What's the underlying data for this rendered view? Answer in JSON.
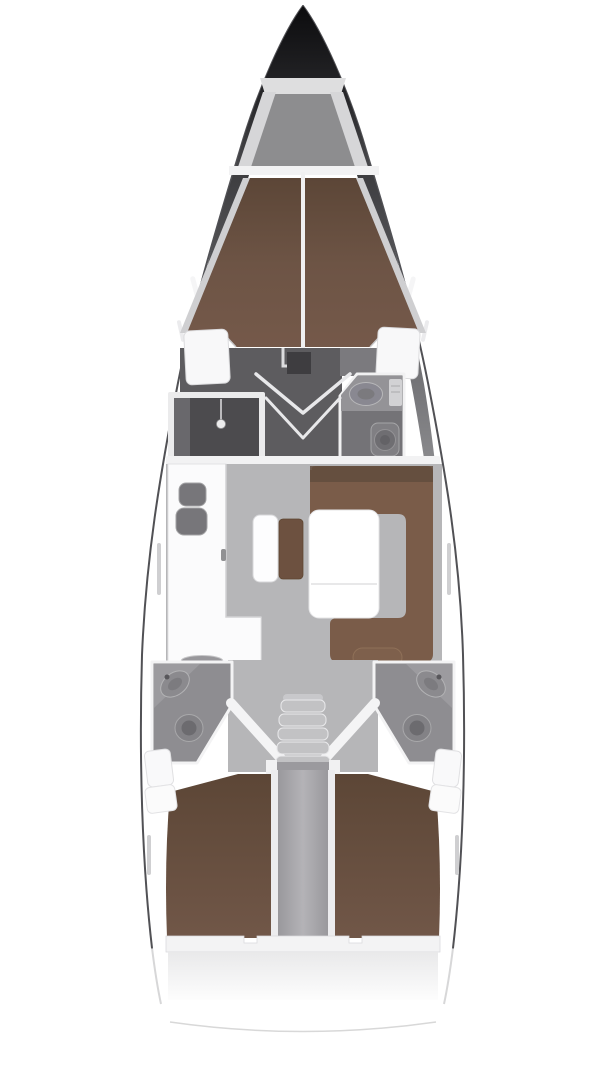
{
  "diagram": {
    "type": "yacht-interior-floor-plan",
    "orientation": "bow-up",
    "rooms": [
      "anchor-locker",
      "forward-cabin-v-berth",
      "forward-vestibule",
      "shower-room",
      "forward-heads",
      "galley",
      "salon",
      "salon-table",
      "u-settee",
      "navigation-bench",
      "companionway-stairs",
      "aft-heads-port",
      "aft-heads-starboard",
      "aft-cabin-port",
      "aft-cabin-starboard",
      "stern-transom"
    ]
  },
  "colors": {
    "hull_outline": "#515155",
    "hull_fill": "#ffffff",
    "anchor_floor": "#8d8d8f",
    "anchor_rail": "#d6d6d8",
    "bulkhead": "#f2f2f3",
    "berth_wall": "#cfcfd1",
    "center_line": "#f0f0f1",
    "vestibule": "#5d5c5f",
    "mid_floor": "#7b7a7e",
    "locker_white": "#f8f8f9",
    "shower_frame": "#ebebec",
    "shower_floor": "#4c4b4e",
    "shower_panel": "#69686c",
    "heads_floor": "#747377",
    "heads_counter": "#949397",
    "sink_gray": "#898891",
    "fixture_gray": "#807f83",
    "salon_floor": "#b6b6b8",
    "galley_counter": "#fbfbfc",
    "sink_basin": "#77767a",
    "stove_gray": "#98979b",
    "bench_white": "#fdfdfe",
    "ottoman_brown": "#6d5140",
    "settee_brown": "#7a5c49",
    "settee_dark": "#624c3d",
    "headrest_brown": "#7e604c",
    "table_white": "#ffffff",
    "aft_heads_floor": "#8e8d91",
    "aft_counter": "#9c9b9f",
    "toilet_gray": "#838286",
    "stairs_gray": "#c2c2c4",
    "partition_wall": "#ececee",
    "stern_wall": "#f3f3f4",
    "transom_line": "#d8d8d8",
    "window_slit": "#cfcfd1"
  }
}
